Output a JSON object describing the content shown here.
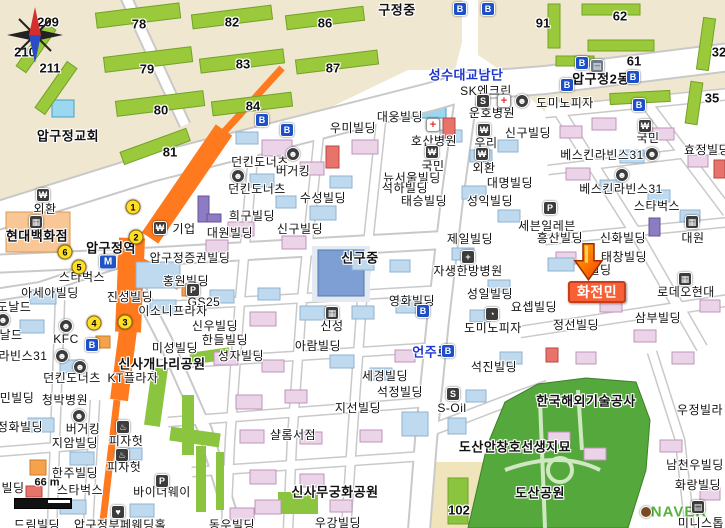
{
  "map": {
    "attribution": "NAVER",
    "scale_text": "66 m",
    "search_result_name": "화전민",
    "marker": {
      "x": 588,
      "y": 278
    },
    "colors": {
      "accent_orange_road": "#ff7a1e",
      "badge": "#f75f35",
      "road_name_blue": "#1d36cf",
      "park_green": "#55a83c",
      "naver_green": "#57b33c"
    }
  },
  "labels": [
    {
      "t": "209",
      "x": 48,
      "y": 22,
      "c": "n"
    },
    {
      "t": "210",
      "x": 25,
      "y": 52,
      "c": "n"
    },
    {
      "t": "211",
      "x": 50,
      "y": 68,
      "c": "n"
    },
    {
      "t": "78",
      "x": 139,
      "y": 24,
      "c": "n"
    },
    {
      "t": "79",
      "x": 147,
      "y": 69,
      "c": "n"
    },
    {
      "t": "80",
      "x": 161,
      "y": 110,
      "c": "n"
    },
    {
      "t": "81",
      "x": 170,
      "y": 152,
      "c": "n"
    },
    {
      "t": "82",
      "x": 232,
      "y": 22,
      "c": "n"
    },
    {
      "t": "83",
      "x": 243,
      "y": 64,
      "c": "n"
    },
    {
      "t": "84",
      "x": 253,
      "y": 106,
      "c": "n"
    },
    {
      "t": "86",
      "x": 325,
      "y": 23,
      "c": "n"
    },
    {
      "t": "87",
      "x": 333,
      "y": 68,
      "c": "n"
    },
    {
      "t": "91",
      "x": 543,
      "y": 23,
      "c": "n"
    },
    {
      "t": "62",
      "x": 620,
      "y": 16,
      "c": "n"
    },
    {
      "t": "61",
      "x": 634,
      "y": 61,
      "c": "n"
    },
    {
      "t": "32",
      "x": 719,
      "y": 52,
      "c": "n"
    },
    {
      "t": "35",
      "x": 712,
      "y": 98,
      "c": "n"
    },
    {
      "t": "102",
      "x": 459,
      "y": 510,
      "c": "n"
    },
    {
      "t": "구정중",
      "x": 397,
      "y": 10,
      "c": "a"
    },
    {
      "t": "압구정2동",
      "x": 601,
      "y": 79,
      "c": "a"
    },
    {
      "t": "압구정교회",
      "x": 68,
      "y": 136,
      "c": "a"
    },
    {
      "t": "압구정역",
      "x": 111,
      "y": 248,
      "c": "a"
    },
    {
      "t": "신구중",
      "x": 360,
      "y": 258,
      "c": "a"
    },
    {
      "t": "현대백화점",
      "x": 37,
      "y": 236,
      "c": "a"
    },
    {
      "t": "신사개나리공원",
      "x": 162,
      "y": 364,
      "c": "a"
    },
    {
      "t": "신사무궁화공원",
      "x": 335,
      "y": 492,
      "c": "a"
    },
    {
      "t": "도산공원",
      "x": 540,
      "y": 493,
      "c": "a"
    },
    {
      "t": "도산안창호선생지묘",
      "x": 515,
      "y": 447,
      "c": "a"
    },
    {
      "t": "한국해외기술공사",
      "x": 586,
      "y": 401,
      "c": "a"
    },
    {
      "t": "성수대교남단",
      "x": 466,
      "y": 75,
      "c": "r"
    },
    {
      "t": "언주로",
      "x": 431,
      "y": 352,
      "c": "r"
    },
    {
      "t": "SK엔크린",
      "x": 486,
      "y": 91,
      "c": "b"
    },
    {
      "t": "도미노피자",
      "x": 565,
      "y": 103,
      "c": "b"
    },
    {
      "t": "운호병원",
      "x": 492,
      "y": 113,
      "c": "b"
    },
    {
      "t": "대웅빌딩",
      "x": 400,
      "y": 117,
      "c": "b"
    },
    {
      "t": "우미빌딩",
      "x": 353,
      "y": 128,
      "c": "b"
    },
    {
      "t": "신구빌딩",
      "x": 528,
      "y": 133,
      "c": "b"
    },
    {
      "t": "호산병원",
      "x": 434,
      "y": 141,
      "c": "b"
    },
    {
      "t": "국민",
      "x": 433,
      "y": 166,
      "c": "b"
    },
    {
      "t": "우리",
      "x": 486,
      "y": 143,
      "c": "b"
    },
    {
      "t": "외환",
      "x": 484,
      "y": 168,
      "c": "b"
    },
    {
      "t": "대명빌딩",
      "x": 510,
      "y": 183,
      "c": "b"
    },
    {
      "t": "뉴서울빌딩",
      "x": 412,
      "y": 178,
      "c": "b"
    },
    {
      "t": "석하빌딩",
      "x": 405,
      "y": 188,
      "c": "b"
    },
    {
      "t": "던킨도너츠",
      "x": 260,
      "y": 162,
      "c": "b"
    },
    {
      "t": "버거킹",
      "x": 293,
      "y": 171,
      "c": "b"
    },
    {
      "t": "던킨도너츠",
      "x": 257,
      "y": 189,
      "c": "b"
    },
    {
      "t": "수성빌딩",
      "x": 323,
      "y": 198,
      "c": "b"
    },
    {
      "t": "태승빌딩",
      "x": 424,
      "y": 201,
      "c": "b"
    },
    {
      "t": "성익빌딩",
      "x": 490,
      "y": 201,
      "c": "b"
    },
    {
      "t": "희구빌딩",
      "x": 252,
      "y": 216,
      "c": "b"
    },
    {
      "t": "대원빌딩",
      "x": 230,
      "y": 233,
      "c": "b"
    },
    {
      "t": "신구빌딩",
      "x": 300,
      "y": 229,
      "c": "b"
    },
    {
      "t": "기업",
      "x": 184,
      "y": 229,
      "c": "b"
    },
    {
      "t": "제일빌딩",
      "x": 470,
      "y": 239,
      "c": "b"
    },
    {
      "t": "압구정증권빌딩",
      "x": 190,
      "y": 258,
      "c": "b"
    },
    {
      "t": "홍원빌딩",
      "x": 186,
      "y": 281,
      "c": "b"
    },
    {
      "t": "진성빌딩",
      "x": 130,
      "y": 297,
      "c": "b"
    },
    {
      "t": "스타벅스",
      "x": 82,
      "y": 277,
      "c": "b"
    },
    {
      "t": "아세아빌딩",
      "x": 50,
      "y": 293,
      "c": "b"
    },
    {
      "t": "KFC",
      "x": 66,
      "y": 339,
      "c": "b"
    },
    {
      "t": "미성빌딩",
      "x": 175,
      "y": 348,
      "c": "b"
    },
    {
      "t": "GS25",
      "x": 204,
      "y": 302,
      "c": "b"
    },
    {
      "t": "이소니프라자",
      "x": 173,
      "y": 311,
      "c": "b"
    },
    {
      "t": "신우빌딩",
      "x": 215,
      "y": 326,
      "c": "b"
    },
    {
      "t": "한들빌딩",
      "x": 225,
      "y": 340,
      "c": "b"
    },
    {
      "t": "성자빌딩",
      "x": 241,
      "y": 356,
      "c": "b"
    },
    {
      "t": "신성",
      "x": 332,
      "y": 326,
      "c": "b"
    },
    {
      "t": "아람빌딩",
      "x": 318,
      "y": 346,
      "c": "b"
    },
    {
      "t": "자생한방병원",
      "x": 468,
      "y": 271,
      "c": "b"
    },
    {
      "t": "성일빌딩",
      "x": 490,
      "y": 294,
      "c": "b"
    },
    {
      "t": "요셉빌딩",
      "x": 534,
      "y": 307,
      "c": "b"
    },
    {
      "t": "도미노피자",
      "x": 493,
      "y": 328,
      "c": "b"
    },
    {
      "t": "영화빌딩",
      "x": 412,
      "y": 301,
      "c": "b"
    },
    {
      "t": "석진빌딩",
      "x": 494,
      "y": 367,
      "c": "b"
    },
    {
      "t": "세경빌딩",
      "x": 385,
      "y": 376,
      "c": "b"
    },
    {
      "t": "석정빌딩",
      "x": 400,
      "y": 392,
      "c": "b"
    },
    {
      "t": "지선빌딩",
      "x": 358,
      "y": 408,
      "c": "b"
    },
    {
      "t": "S-Oil",
      "x": 452,
      "y": 408,
      "c": "b"
    },
    {
      "t": "샬롬서점",
      "x": 293,
      "y": 435,
      "c": "b"
    },
    {
      "t": "세븐일레븐",
      "x": 547,
      "y": 226,
      "c": "b"
    },
    {
      "t": "흥산빌딩",
      "x": 560,
      "y": 238,
      "c": "b"
    },
    {
      "t": "신화빌딩",
      "x": 623,
      "y": 238,
      "c": "b"
    },
    {
      "t": "태창빌딩",
      "x": 624,
      "y": 257,
      "c": "b"
    },
    {
      "t": "국민",
      "x": 648,
      "y": 138,
      "c": "b"
    },
    {
      "t": "베스킨라빈스31",
      "x": 602,
      "y": 155,
      "c": "b"
    },
    {
      "t": "베스킨라빈스31",
      "x": 621,
      "y": 189,
      "c": "b"
    },
    {
      "t": "스타벅스",
      "x": 657,
      "y": 206,
      "c": "b"
    },
    {
      "t": "효정빌딩",
      "x": 707,
      "y": 150,
      "c": "b"
    },
    {
      "t": "대원",
      "x": 693,
      "y": 238,
      "c": "b"
    },
    {
      "t": "로데오현대",
      "x": 686,
      "y": 292,
      "c": "b"
    },
    {
      "t": "정선빌딩",
      "x": 576,
      "y": 325,
      "c": "b"
    },
    {
      "t": "삼부빌딩",
      "x": 658,
      "y": 318,
      "c": "b"
    },
    {
      "t": "외환",
      "x": 45,
      "y": 209,
      "c": "b"
    },
    {
      "t": "청박병원",
      "x": 65,
      "y": 400,
      "c": "b"
    },
    {
      "t": "버거킹",
      "x": 83,
      "y": 429,
      "c": "b"
    },
    {
      "t": "지암빌딩",
      "x": 75,
      "y": 443,
      "c": "b"
    },
    {
      "t": "피자헛",
      "x": 126,
      "y": 441,
      "c": "b"
    },
    {
      "t": "피자헛",
      "x": 124,
      "y": 467,
      "c": "b"
    },
    {
      "t": "한주빌딩",
      "x": 75,
      "y": 473,
      "c": "b"
    },
    {
      "t": "스타벅스",
      "x": 80,
      "y": 490,
      "c": "b"
    },
    {
      "t": "바이더웨이",
      "x": 162,
      "y": 492,
      "c": "b"
    },
    {
      "t": "우정빌라",
      "x": 700,
      "y": 410,
      "c": "b"
    },
    {
      "t": "남천우빌딩",
      "x": 695,
      "y": 465,
      "c": "b"
    },
    {
      "t": "화랑빌딩",
      "x": 698,
      "y": 485,
      "c": "b"
    },
    {
      "t": "미니스톱",
      "x": 701,
      "y": 523,
      "c": "b"
    },
    {
      "t": "동우빌딩",
      "x": 232,
      "y": 525,
      "c": "b"
    },
    {
      "t": "우강빌딩",
      "x": 338,
      "y": 523,
      "c": "b"
    },
    {
      "t": "드림빌딩",
      "x": 37,
      "y": 525,
      "c": "b"
    },
    {
      "t": "압구정부페웨딩홀",
      "x": 120,
      "y": 525,
      "c": "b"
    },
    {
      "t": "던킨도너츠",
      "x": 72,
      "y": 378,
      "c": "b"
    },
    {
      "t": "KT플라자",
      "x": 133,
      "y": 378,
      "c": "b"
    },
    {
      "t": "도날드",
      "x": 14,
      "y": 307,
      "c": "f"
    },
    {
      "t": "날드",
      "x": 11,
      "y": 335,
      "c": "f"
    },
    {
      "t": "라빈스31",
      "x": 23,
      "y": 356,
      "c": "f"
    },
    {
      "t": "민빌딩",
      "x": 17,
      "y": 398,
      "c": "f"
    },
    {
      "t": "정화빌딩",
      "x": 20,
      "y": 427,
      "c": "f"
    },
    {
      "t": "빌딩",
      "x": 13,
      "y": 488,
      "c": "f"
    },
    {
      "t": "빌딩",
      "x": 600,
      "y": 270,
      "c": "f"
    },
    {
      "t": "화전민",
      "x": 597,
      "y": 292,
      "c": "g"
    },
    {
      "t": "66 m",
      "x": 47,
      "y": 483,
      "c": "s"
    },
    {
      "t": "NAVER",
      "x": 679,
      "y": 512,
      "c": "w"
    }
  ],
  "icons": [
    {
      "k": "bus",
      "x": 460,
      "y": 9
    },
    {
      "k": "bus",
      "x": 488,
      "y": 9
    },
    {
      "k": "bus",
      "x": 582,
      "y": 63
    },
    {
      "k": "bus",
      "x": 633,
      "y": 77
    },
    {
      "k": "bus",
      "x": 567,
      "y": 85
    },
    {
      "k": "bus",
      "x": 639,
      "y": 105
    },
    {
      "k": "bus",
      "x": 262,
      "y": 120
    },
    {
      "k": "bus",
      "x": 287,
      "y": 130
    },
    {
      "k": "bus",
      "x": 423,
      "y": 311
    },
    {
      "k": "bus",
      "x": 448,
      "y": 351
    },
    {
      "k": "bus",
      "x": 92,
      "y": 345
    },
    {
      "k": "exit",
      "g": "1",
      "x": 133,
      "y": 207
    },
    {
      "k": "exit",
      "g": "2",
      "x": 136,
      "y": 237
    },
    {
      "k": "exit",
      "g": "3",
      "x": 125,
      "y": 322
    },
    {
      "k": "exit",
      "g": "4",
      "x": 94,
      "y": 323
    },
    {
      "k": "exit",
      "g": "5",
      "x": 79,
      "y": 267
    },
    {
      "k": "exit",
      "g": "6",
      "x": 65,
      "y": 252
    },
    {
      "k": "station",
      "x": 108,
      "y": 262
    },
    {
      "k": "bank",
      "x": 432,
      "y": 152
    },
    {
      "k": "bank",
      "x": 484,
      "y": 130
    },
    {
      "k": "bank",
      "x": 482,
      "y": 154
    },
    {
      "k": "bank",
      "x": 645,
      "y": 126
    },
    {
      "k": "bank",
      "x": 160,
      "y": 228
    },
    {
      "k": "bank",
      "x": 43,
      "y": 195
    },
    {
      "k": "dept",
      "x": 36,
      "y": 222
    },
    {
      "k": "office",
      "x": 597,
      "y": 66
    },
    {
      "k": "hosp",
      "x": 433,
      "y": 125
    },
    {
      "k": "hosp",
      "x": 504,
      "y": 101
    },
    {
      "k": "hospd",
      "x": 468,
      "y": 257
    },
    {
      "k": "food",
      "x": 293,
      "y": 154
    },
    {
      "k": "food",
      "x": 238,
      "y": 176
    },
    {
      "k": "food",
      "x": 652,
      "y": 154
    },
    {
      "k": "food",
      "x": 622,
      "y": 175
    },
    {
      "k": "food",
      "x": 66,
      "y": 326
    },
    {
      "k": "food",
      "x": 3,
      "y": 320
    },
    {
      "k": "food",
      "x": 62,
      "y": 356
    },
    {
      "k": "food",
      "x": 80,
      "y": 367
    },
    {
      "k": "food",
      "x": 79,
      "y": 416
    },
    {
      "k": "food",
      "x": 522,
      "y": 101
    },
    {
      "k": "cup",
      "x": 123,
      "y": 427
    },
    {
      "k": "cup",
      "x": 122,
      "y": 455
    },
    {
      "k": "pizza",
      "x": 492,
      "y": 314
    },
    {
      "k": "gas",
      "x": 483,
      "y": 101
    },
    {
      "k": "gas",
      "x": 453,
      "y": 394
    },
    {
      "k": "park",
      "x": 193,
      "y": 290
    },
    {
      "k": "park",
      "x": 550,
      "y": 208
    },
    {
      "k": "park",
      "x": 162,
      "y": 481
    },
    {
      "k": "bldg",
      "x": 692,
      "y": 222
    },
    {
      "k": "bldg",
      "x": 332,
      "y": 313
    },
    {
      "k": "bldg",
      "x": 685,
      "y": 279
    },
    {
      "k": "heart",
      "x": 118,
      "y": 512
    },
    {
      "k": "shop",
      "x": 698,
      "y": 507
    },
    {
      "k": "ndot",
      "x": 646,
      "y": 512
    }
  ]
}
